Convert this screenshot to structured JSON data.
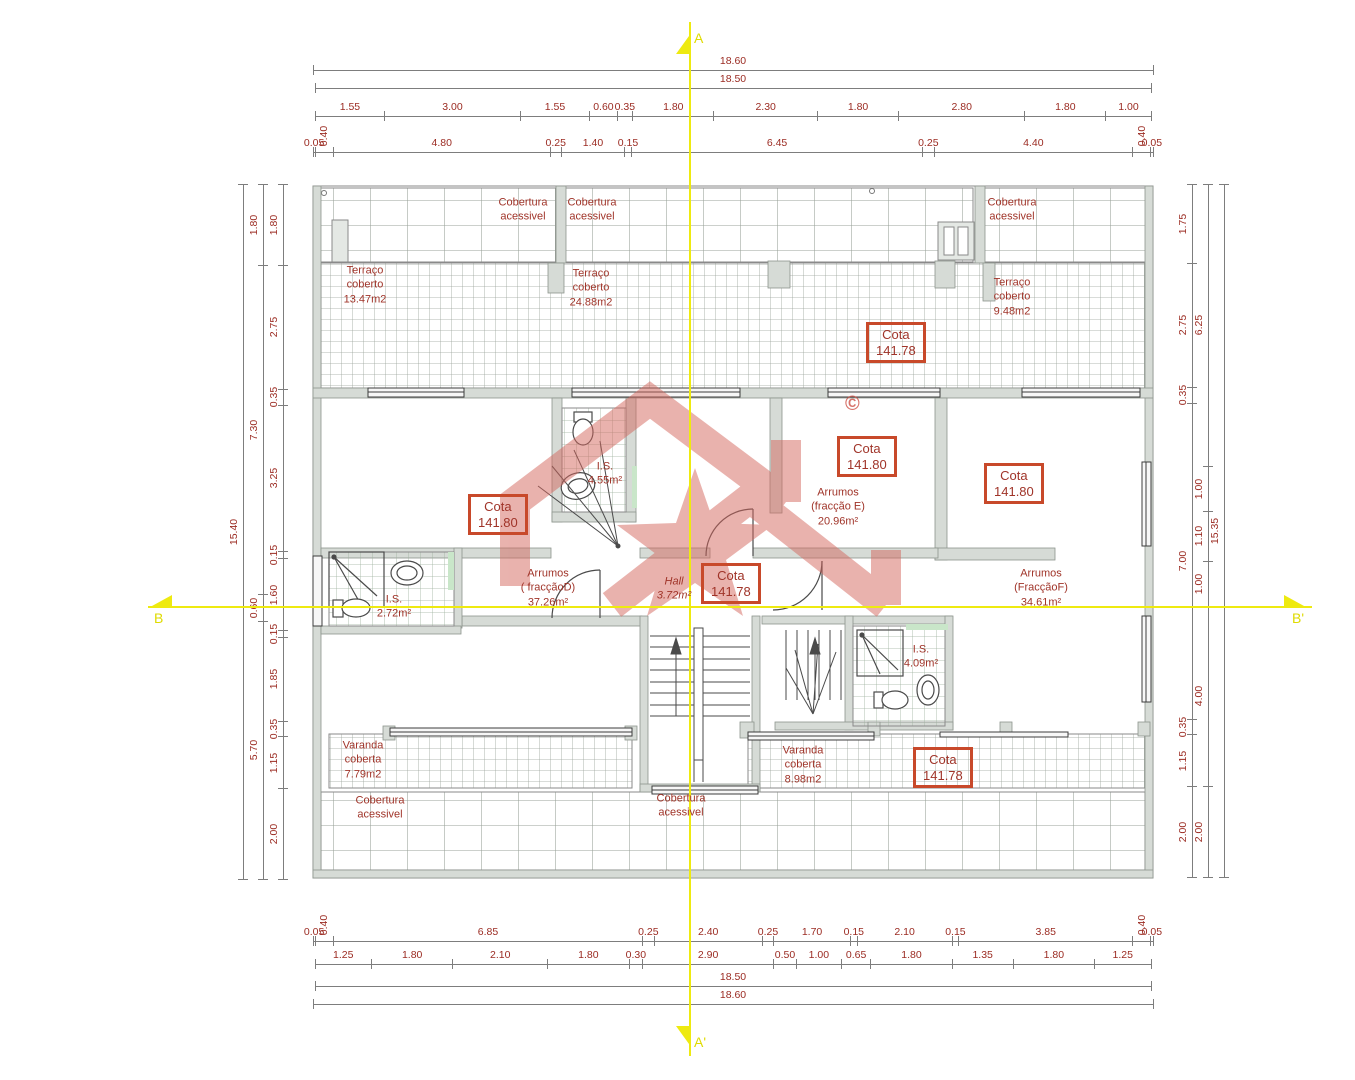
{
  "colors": {
    "annotation_red": "#a03429",
    "cota_border": "#c8492a",
    "axis_yellow": "#eeea10",
    "watermark_salmon": "#d4675e",
    "wall_gray": "#d6dbd6"
  },
  "axes": {
    "top": "A",
    "bottom": "A'",
    "left": "B",
    "right": "B'"
  },
  "watermark": {
    "mark": "©"
  },
  "dimensions": {
    "top_total": [
      "18.60"
    ],
    "top_sub": [
      "18.50"
    ],
    "top_axis": [
      "1.55",
      "3.00",
      "1.55",
      "0.60",
      "0.35",
      "1.80",
      "2.30",
      "1.80",
      "2.80",
      "1.80",
      "1.00"
    ],
    "top_detail": [
      "0.05",
      "0.40",
      "4.80",
      "0.25",
      "1.40",
      "0.15",
      "6.45",
      "0.25",
      "4.40",
      "0.40",
      "0.05"
    ],
    "bottom_detail": [
      "0.05",
      "0.40",
      "6.85",
      "0.25",
      "2.40",
      "0.25",
      "1.70",
      "0.15",
      "2.10",
      "0.15",
      "3.85",
      "0.40",
      "0.05"
    ],
    "bottom_axis": [
      "1.25",
      "1.80",
      "2.10",
      "1.80",
      "0.30",
      "2.90",
      "0.50",
      "1.00",
      "0.65",
      "1.80",
      "1.35",
      "1.80",
      "1.25"
    ],
    "bottom_sub": [
      "18.50"
    ],
    "bottom_total": [
      "18.60"
    ],
    "left_outer": [
      "15.40"
    ],
    "left_mid": [
      "1.80",
      "7.30",
      "0.60",
      "5.70"
    ],
    "left_inner": [
      "1.80",
      "2.75",
      "0.35",
      "3.25",
      "0.15",
      "1.60",
      "0.15",
      "1.85",
      "0.35",
      "1.15",
      "2.00"
    ],
    "right_inner": [
      "1.75",
      "2.75",
      "0.35",
      "7.00",
      "0.35",
      "1.15",
      "2.00"
    ],
    "right_mid": [
      "6.25",
      "1.00",
      "1.10",
      "1.00",
      "4.00",
      "2.00"
    ],
    "right_outer": [
      "15.35"
    ]
  },
  "rooms": {
    "cob_top_left": "Cobertura\nacessivel",
    "cob_top_mid": "Cobertura\nacessivel",
    "cob_top_right": "Cobertura\nacessivel",
    "cob_bot_left": "Cobertura\nacessivel",
    "cob_bot_mid": "Cobertura\nacessivel",
    "ter_left": "Terraço\ncoberto\n13.47m2",
    "ter_mid": "Terraço\ncoberto\n24.88m2",
    "ter_right": "Terraço\ncoberto\n9.48m2",
    "is_center": "I.S.\n4.55m²",
    "is_left": "I.S.\n2.72m²",
    "is_right": "I.S.\n4.09m²",
    "arr_d": "Arrumos\n( fracçãoD)\n37.26m²",
    "hall": "Hall\n3.72m²",
    "arr_e": "Arrumos\n(fracção E)\n20.96m²",
    "arr_f": "Arrumos\n(FracçãoF)\n34.61m²",
    "var_left": "Varanda\ncoberta\n7.79m2",
    "var_mid": "Varanda\ncoberta\n8.98m2"
  },
  "cotas": [
    {
      "label": "Cota",
      "value": "141.78"
    },
    {
      "label": "Cota",
      "value": "141.80"
    },
    {
      "label": "Cota",
      "value": "141.80"
    },
    {
      "label": "Cota",
      "value": "141.80"
    },
    {
      "label": "Cota",
      "value": "141.78"
    },
    {
      "label": "Cota",
      "value": "141.78"
    }
  ]
}
